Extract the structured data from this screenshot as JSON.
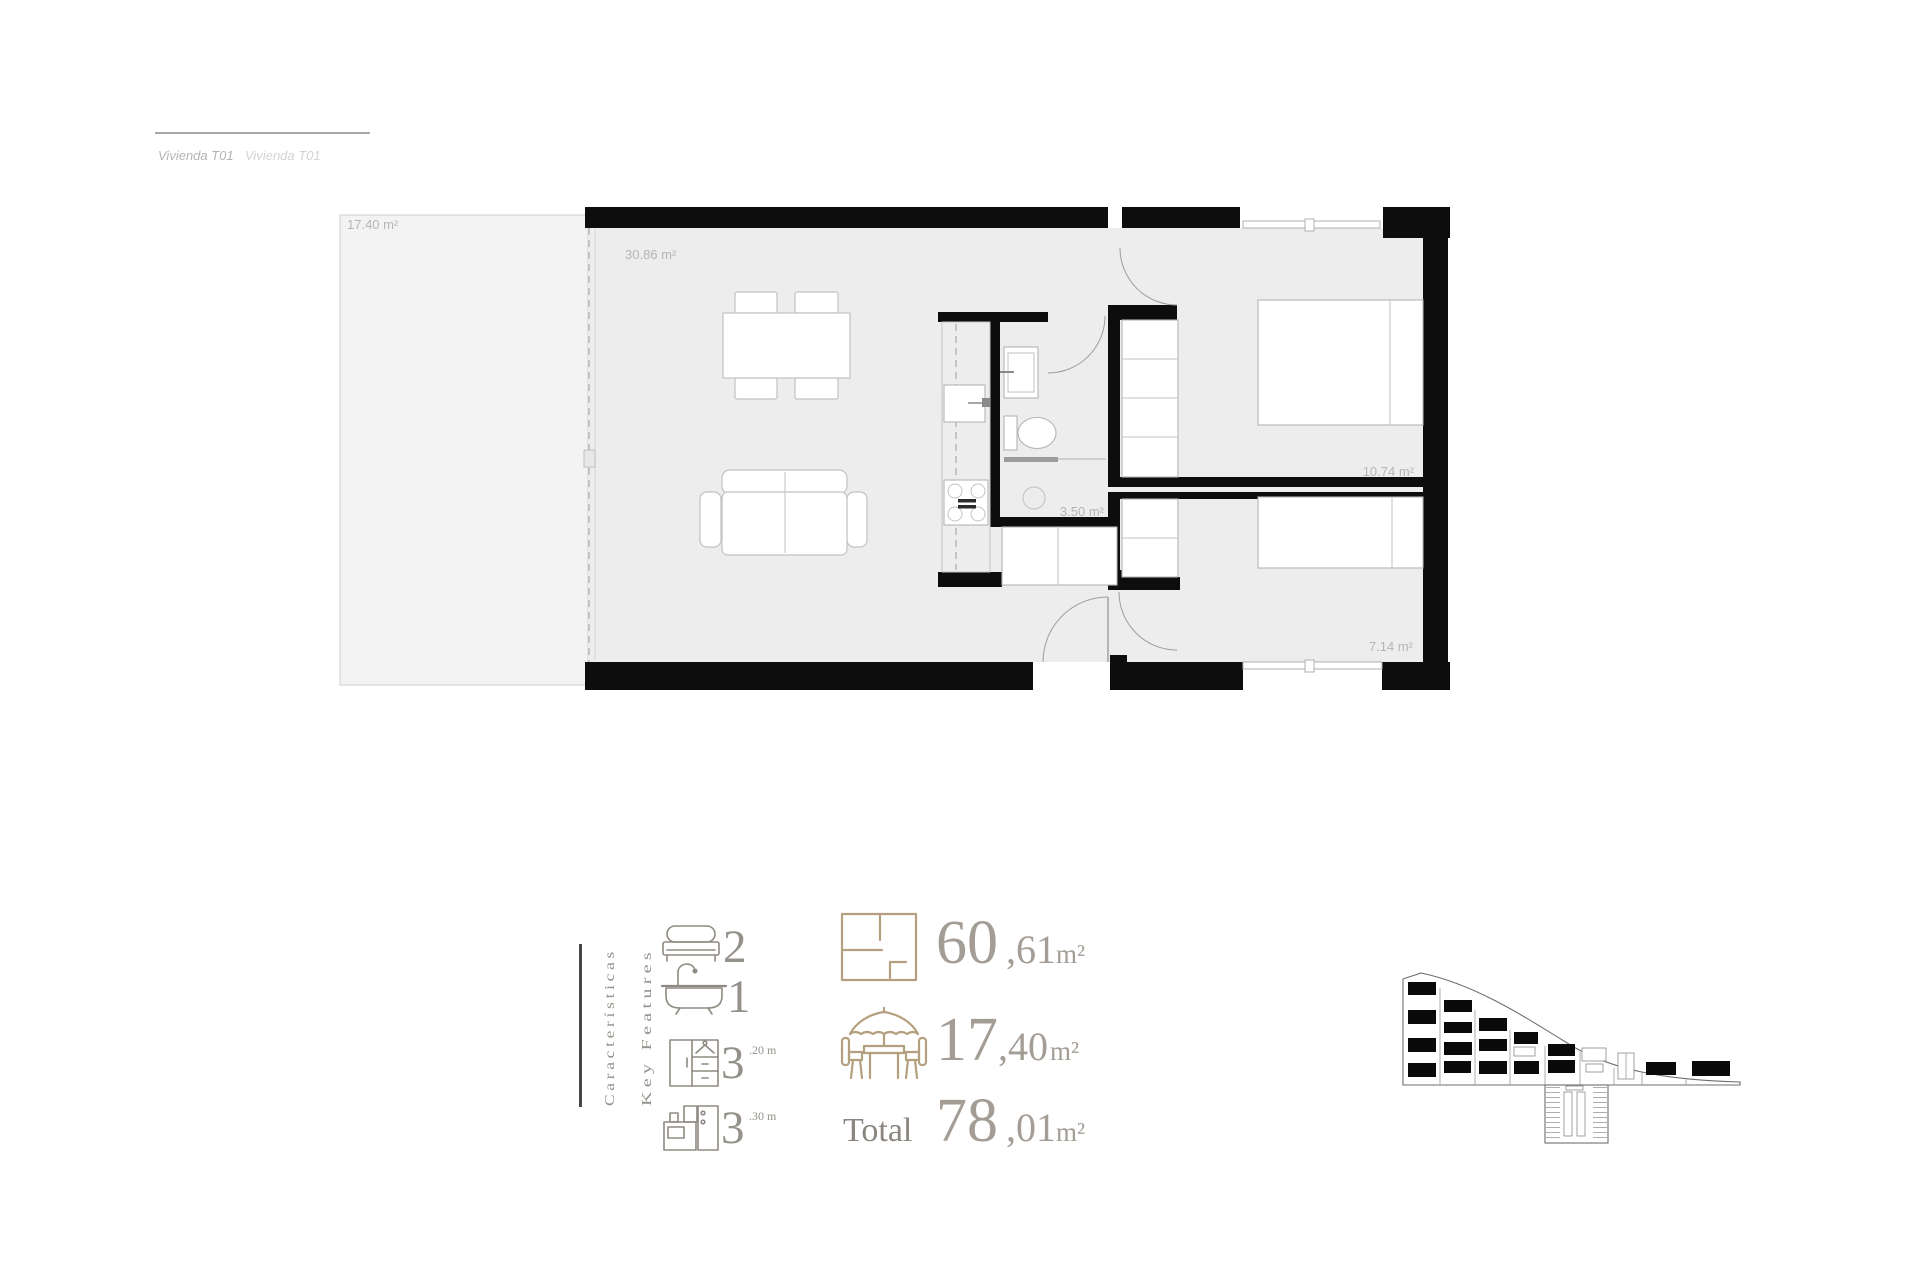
{
  "header": {
    "title_primary": "Vivienda T01",
    "title_secondary": "Vivienda T01"
  },
  "plan": {
    "labels": {
      "terrace": "17.40 m²",
      "living": "30.86 m²",
      "bathroom": "3.50 m²",
      "bedroom1": "10.74 m²",
      "bedroom2": "7.14 m²"
    }
  },
  "features": {
    "heading_es": "Características",
    "heading_en": "Key Features",
    "items": [
      {
        "name": "bedrooms",
        "icon": "bed-icon",
        "value": "2",
        "note": ""
      },
      {
        "name": "bathrooms",
        "icon": "bathtub-icon",
        "value": "1",
        "note": ""
      },
      {
        "name": "wardrobe",
        "icon": "wardrobe-icon",
        "value": "3",
        "note": ".20 m"
      },
      {
        "name": "kitchen",
        "icon": "kitchen-icon",
        "value": "3",
        "note": ".30 m"
      }
    ]
  },
  "areas": {
    "interior": {
      "int": "60",
      "dec": ",61",
      "unit": "m²"
    },
    "terrace": {
      "int": "17",
      "dec": ",40",
      "unit": "m²"
    },
    "total_label": "Total",
    "total": {
      "int": "78",
      "dec": ",01",
      "unit": "m²"
    }
  },
  "colors": {
    "wall": "#0d0d0d",
    "floor": "#ededed",
    "terrace": "#f3f3f3",
    "accent": "#b49f7e",
    "labelgray": "#b5b5b5",
    "feattext": "#94908a",
    "areatext": "#a39d95",
    "totaltext": "#8a857f"
  }
}
